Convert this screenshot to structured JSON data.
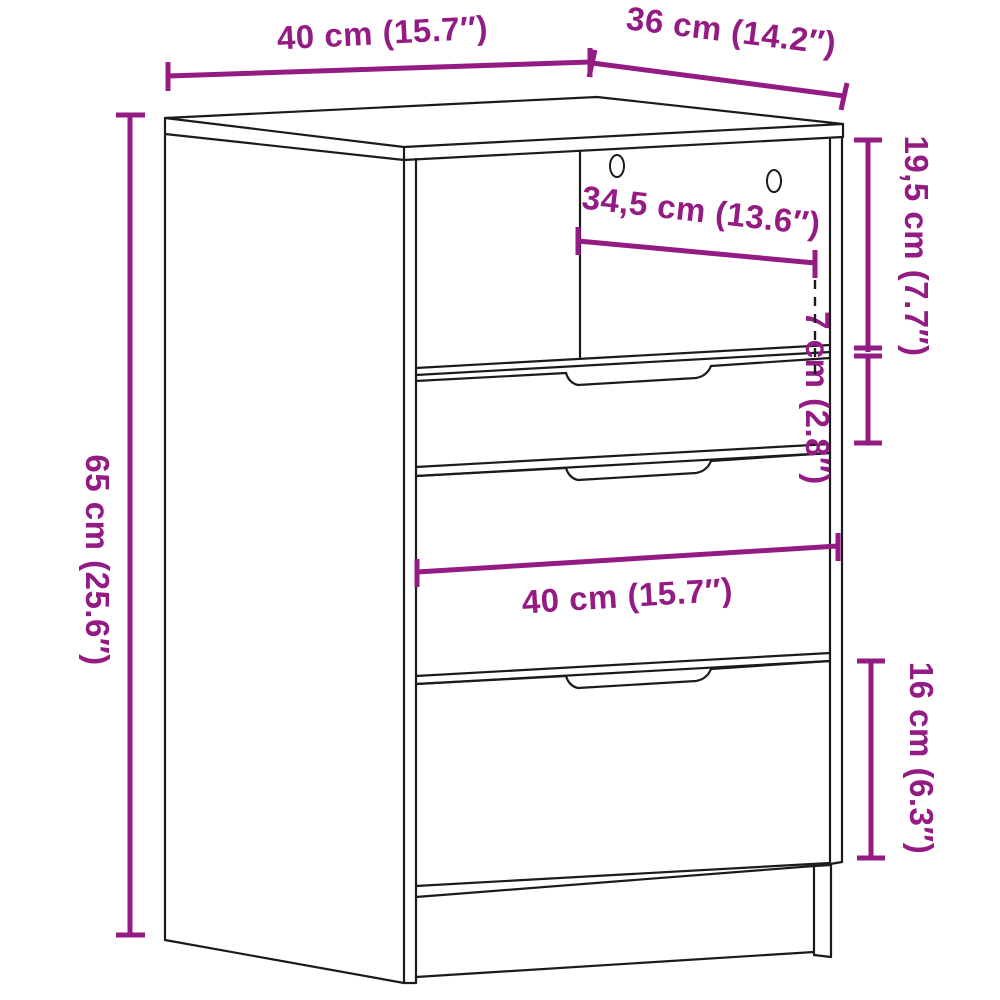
{
  "diagram": {
    "kind": "furniture-dimension-line-drawing",
    "subject": "bedside cabinet with open compartment and three drawers",
    "background_color": "#ffffff",
    "outline_color": "#1b1b1b",
    "accent_color": "#941b84",
    "dimensions": [
      {
        "id": "width-top",
        "label": "40 cm (15.7″)"
      },
      {
        "id": "depth-top",
        "label": "36 cm (14.2″)"
      },
      {
        "id": "compartment-height",
        "label": "19,5 cm (7.7″)"
      },
      {
        "id": "top-drawer-height",
        "label": "7 cm (2.8″)"
      },
      {
        "id": "compartment-width",
        "label": "34,5 cm (13.6″)"
      },
      {
        "id": "total-height",
        "label": "65 cm (25.6″)"
      },
      {
        "id": "drawer-width",
        "label": "40 cm (15.7″)"
      },
      {
        "id": "bottom-drawer-height",
        "label": "16 cm (6.3″)"
      }
    ]
  }
}
